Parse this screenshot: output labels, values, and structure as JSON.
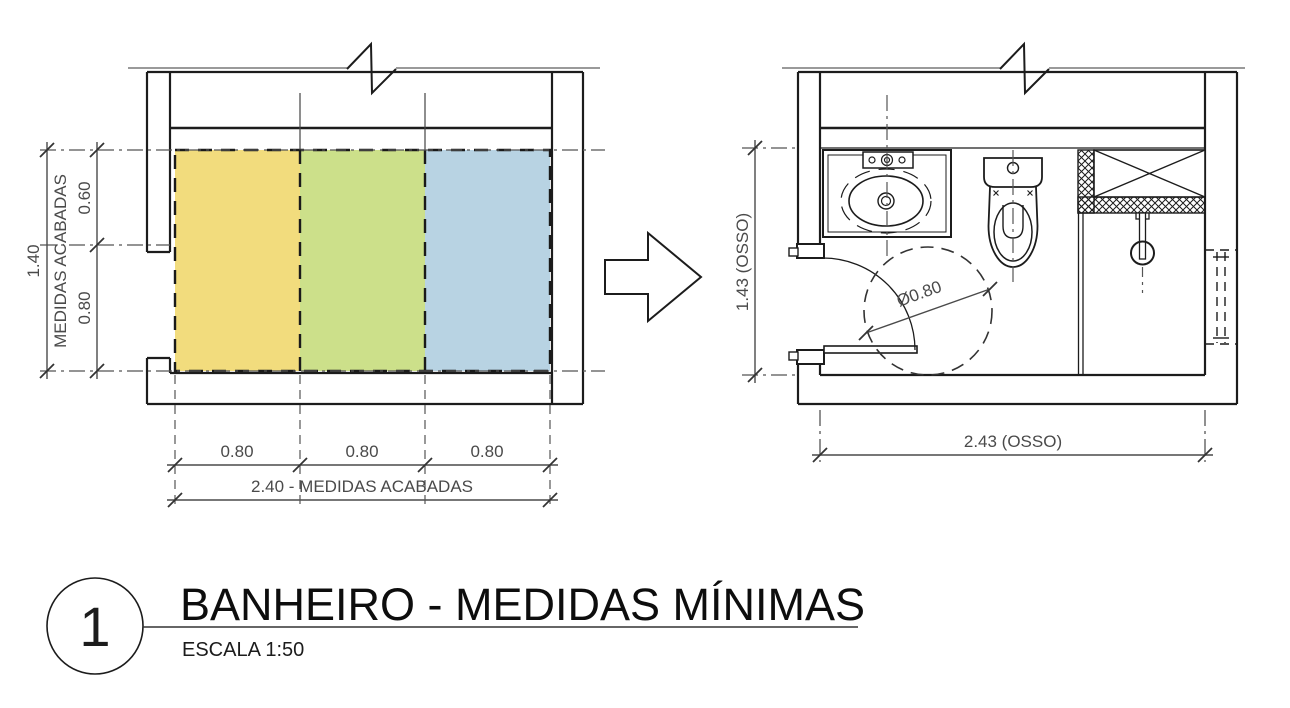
{
  "title_block": {
    "number": "1",
    "title": "BANHEIRO - MEDIDAS MÍNIMAS",
    "scale": "ESCALA 1:50"
  },
  "left_plan": {
    "height_total": "1.40",
    "height_axis_label": "MEDIDAS ACABADAS",
    "height_top": "0.60",
    "height_bottom": "0.80",
    "widths": [
      "0.80",
      "0.80",
      "0.80"
    ],
    "width_total": "2.40 - MEDIDAS ACABADAS"
  },
  "right_plan": {
    "height_total": "1.43 (OSSO)",
    "width_total": "2.43 (OSSO)",
    "turn_circle_diameter": "Ø0.80"
  },
  "colors": {
    "zone_yellow": "#F2DC7D",
    "zone_green": "#CCE08A",
    "zone_blue": "#B8D3E3",
    "ink": "#1c1c1c",
    "dim_ink": "#4a4a4a"
  }
}
